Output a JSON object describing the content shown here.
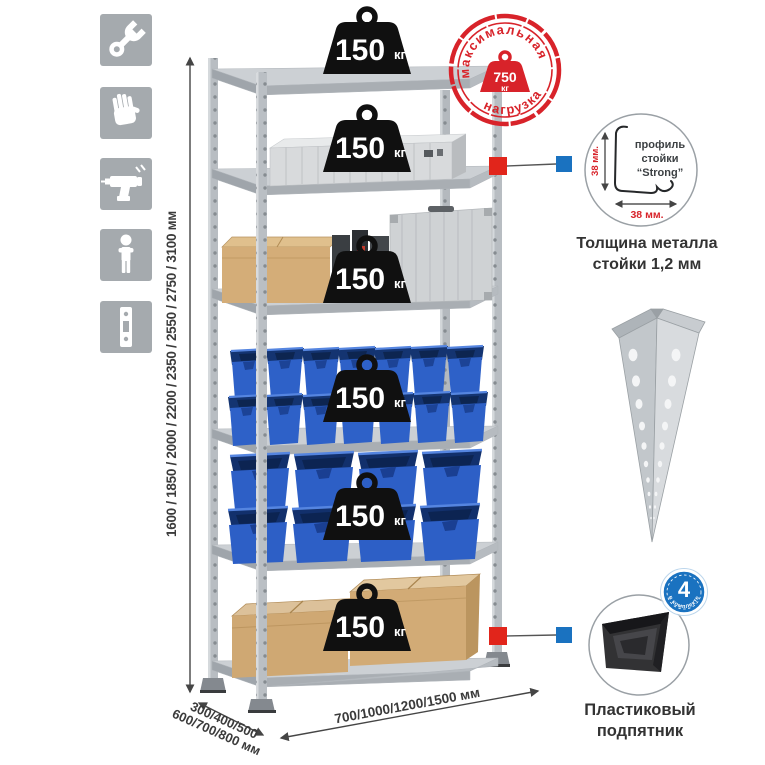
{
  "colors": {
    "accent_red": "#d8232a",
    "marker_red": "#e1251b",
    "marker_blue": "#1a72c0",
    "bin_blue": "#2d5fc6",
    "icon_bg": "#a5aaae"
  },
  "left_icons": [
    {
      "name": "wrench-icon"
    },
    {
      "name": "gloves-icon"
    },
    {
      "name": "drill-icon"
    },
    {
      "name": "person-icon"
    },
    {
      "name": "post-profile-icon"
    }
  ],
  "height_dimension": {
    "label": "1600 / 1850 / 2000 / 2200 / 2350 / 2550 / 2750 / 3100 мм"
  },
  "depth_dimension": {
    "line1": "300/400/500",
    "line2": "600/700/800 мм"
  },
  "width_dimension": {
    "label": "700/1000/1200/1500 мм"
  },
  "shelf_badges": [
    {
      "value": "150",
      "unit": "кг"
    },
    {
      "value": "150",
      "unit": "кг"
    },
    {
      "value": "150",
      "unit": "кг"
    },
    {
      "value": "150",
      "unit": "кг"
    },
    {
      "value": "150",
      "unit": "кг"
    },
    {
      "value": "150",
      "unit": "кг"
    }
  ],
  "max_load_stamp": {
    "arc_top": "максимальная",
    "arc_bottom": "нагрузка",
    "value": "750",
    "unit": "кг"
  },
  "profile_detail": {
    "label_line1": "профиль",
    "label_line2": "стойки",
    "label_line3": "“Strong”",
    "vertical_dim": "38 мм.",
    "horizontal_dim": "38 мм.",
    "caption_line1": "Толщина металла",
    "caption_line2": "стойки 1,2 мм"
  },
  "foot_detail": {
    "badge_value": "4",
    "badge_arc": "в комплекте",
    "caption_line1": "Пластиковый",
    "caption_line2": "подпятник"
  }
}
